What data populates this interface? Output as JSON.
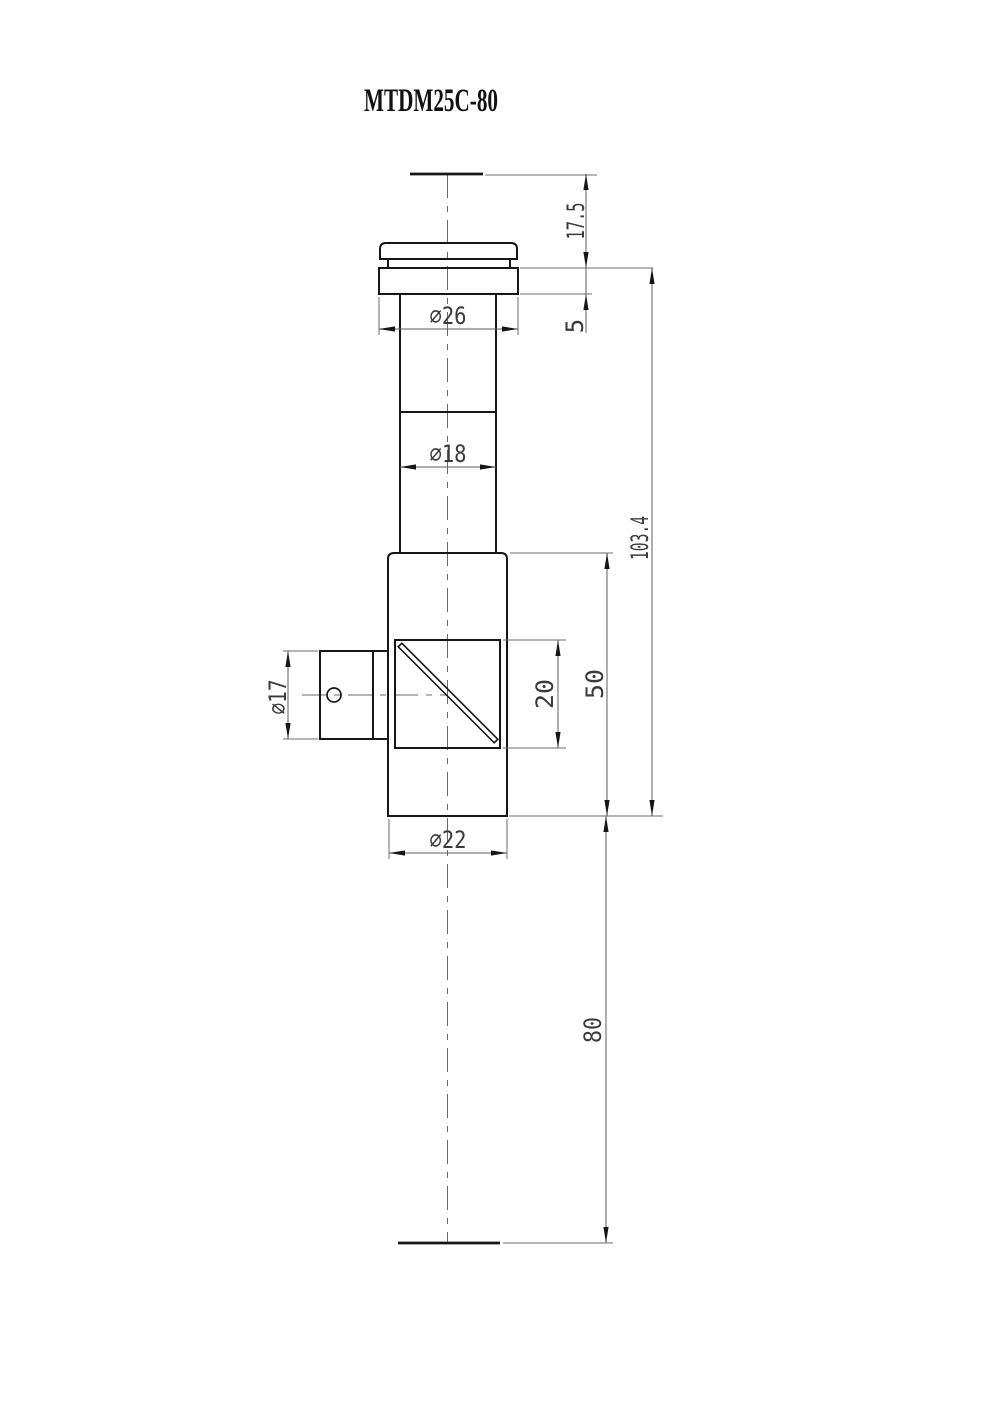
{
  "title": "MTDM25C-80",
  "dimensions": {
    "top_clearance": "17.5",
    "flange_thickness": "5",
    "flange_diameter": "⌀26",
    "tube_diameter": "⌀18",
    "overall_length": "103.4",
    "side_port_diameter": "⌀17",
    "prism_aperture": "20",
    "body_length": "50",
    "body_diameter": "⌀22",
    "lower_extension": "80"
  },
  "colors": {
    "outline": "#161616",
    "dimension_lines": "#5c5c5c",
    "text": "#3a3a3a",
    "background": "#ffffff"
  }
}
